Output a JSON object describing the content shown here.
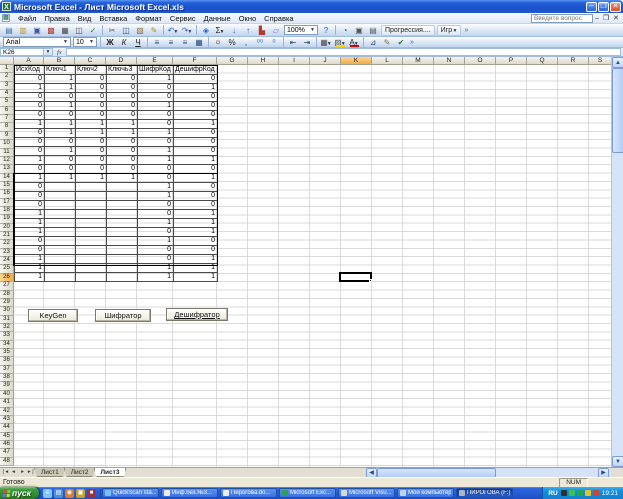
{
  "window": {
    "title": "Microsoft Excel - Лист Microsoft Excel.xls",
    "question_placeholder": "Введите вопрос"
  },
  "menus": [
    {
      "key": "file",
      "label": "Файл"
    },
    {
      "key": "edit",
      "label": "Правка"
    },
    {
      "key": "view",
      "label": "Вид"
    },
    {
      "key": "insert",
      "label": "Вставка"
    },
    {
      "key": "format",
      "label": "Формат"
    },
    {
      "key": "tools",
      "label": "Сервис"
    },
    {
      "key": "data",
      "label": "Данные"
    },
    {
      "key": "window",
      "label": "Окно"
    },
    {
      "key": "help",
      "label": "Справка"
    }
  ],
  "toolbar": {
    "font_name": "Arial",
    "font_size": "10",
    "zoom": "100%",
    "fx_label": "fx"
  },
  "toolbar1": [
    {
      "t": "i",
      "n": "new-icon",
      "g": "▤",
      "c": "#3a6ea5"
    },
    {
      "t": "i",
      "n": "open-icon",
      "g": "▥",
      "c": "#c09731"
    },
    {
      "t": "i",
      "n": "save-icon",
      "g": "▣",
      "c": "#39589c"
    },
    {
      "t": "i",
      "n": "permission-icon",
      "g": "▩",
      "c": "#b03a2e"
    },
    {
      "t": "i",
      "n": "print-icon",
      "g": "▦",
      "c": "#4a4a4a"
    },
    {
      "t": "i",
      "n": "print-preview-icon",
      "g": "◫",
      "c": "#4a4a4a"
    },
    {
      "t": "i",
      "n": "spelling-icon",
      "g": "✓",
      "c": "#2e7d32"
    },
    {
      "t": "s"
    },
    {
      "t": "i",
      "n": "cut-icon",
      "g": "✂",
      "c": "#555555"
    },
    {
      "t": "i",
      "n": "copy-icon",
      "g": "◫",
      "c": "#2b4a7d"
    },
    {
      "t": "i",
      "n": "paste-icon",
      "g": "▧",
      "c": "#8a6d3b"
    },
    {
      "t": "i",
      "n": "format-painter-icon",
      "g": "✎",
      "c": "#b58900"
    },
    {
      "t": "s"
    },
    {
      "t": "i",
      "n": "undo-icon",
      "g": "↶",
      "c": "#2b62c9",
      "d": 1
    },
    {
      "t": "i",
      "n": "redo-icon",
      "g": "↷",
      "c": "#2b62c9",
      "d": 1
    },
    {
      "t": "s"
    },
    {
      "t": "i",
      "n": "hyperlink-icon",
      "g": "◈",
      "c": "#2b62c9"
    },
    {
      "t": "i",
      "n": "autosum-icon",
      "g": "Σ",
      "c": "#222222",
      "d": 1
    },
    {
      "t": "i",
      "n": "sort-ascending-icon",
      "g": "↓",
      "c": "#2b62c9"
    },
    {
      "t": "i",
      "n": "sort-descending-icon",
      "g": "↑",
      "c": "#2b62c9"
    },
    {
      "t": "i",
      "n": "chart-wizard-icon",
      "g": "▙",
      "c": "#b03a2e"
    },
    {
      "t": "i",
      "n": "drawing-icon",
      "g": "▱",
      "c": "#6a5acd"
    },
    {
      "t": "z"
    },
    {
      "t": "i",
      "n": "help-icon",
      "g": "?",
      "c": "#1a5bd0"
    },
    {
      "t": "s"
    },
    {
      "t": "i",
      "n": "custom-tool-icon-1",
      "g": "◔",
      "c": "#2b4a7d"
    },
    {
      "t": "i",
      "n": "camera-icon",
      "g": "▣",
      "c": "#555555"
    },
    {
      "t": "i",
      "n": "document-tool-icon",
      "g": "▤",
      "c": "#555555"
    },
    {
      "t": "b",
      "n": "progression-button",
      "label": "Прогрессия...."
    },
    {
      "t": "b",
      "n": "igr-button",
      "label": "Игр",
      "d": 1
    },
    {
      "t": "v",
      "n": "toolbar-options-icon"
    }
  ],
  "toolbar2": [
    {
      "t": "font"
    },
    {
      "t": "size"
    },
    {
      "t": "s"
    },
    {
      "t": "i",
      "n": "bold-icon",
      "g": "Ж",
      "c": "#222222",
      "cls": "g-b"
    },
    {
      "t": "i",
      "n": "italic-icon",
      "g": "К",
      "c": "#222222",
      "cls": "g-i"
    },
    {
      "t": "i",
      "n": "underline-icon",
      "g": "Ч",
      "c": "#222222",
      "cls": "g-u"
    },
    {
      "t": "s"
    },
    {
      "t": "i",
      "n": "align-left-icon",
      "g": "≡",
      "c": "#2b4a7d"
    },
    {
      "t": "i",
      "n": "align-center-icon",
      "g": "≡",
      "c": "#2b4a7d"
    },
    {
      "t": "i",
      "n": "align-right-icon",
      "g": "≡",
      "c": "#2b4a7d"
    },
    {
      "t": "i",
      "n": "merge-center-icon",
      "g": "▦",
      "c": "#2b4a7d"
    },
    {
      "t": "s"
    },
    {
      "t": "i",
      "n": "currency-icon",
      "g": "¤",
      "c": "#8a6d3b"
    },
    {
      "t": "i",
      "n": "percent-icon",
      "g": "%",
      "c": "#222222"
    },
    {
      "t": "i",
      "n": "comma-style-icon",
      "g": ",",
      "c": "#222222"
    },
    {
      "t": "i",
      "n": "increase-decimal-icon",
      "g": "⁰⁰",
      "c": "#2b62c9"
    },
    {
      "t": "i",
      "n": "decrease-decimal-icon",
      "g": "⁰",
      "c": "#2b62c9"
    },
    {
      "t": "s"
    },
    {
      "t": "i",
      "n": "decrease-indent-icon",
      "g": "⇤",
      "c": "#2b4a7d"
    },
    {
      "t": "i",
      "n": "increase-indent-icon",
      "g": "⇥",
      "c": "#2b4a7d"
    },
    {
      "t": "s"
    },
    {
      "t": "i",
      "n": "borders-icon",
      "g": "▦",
      "c": "#4a4a4a",
      "d": 1
    },
    {
      "t": "i",
      "n": "fill-color-icon",
      "g": "▨",
      "c": "#4a4a4a",
      "bar": "#ffd400",
      "d": 1
    },
    {
      "t": "i",
      "n": "font-color-icon",
      "g": "А",
      "c": "#222222",
      "bar": "#d00000",
      "d": 1
    },
    {
      "t": "s"
    },
    {
      "t": "i",
      "n": "draw-select-icon",
      "g": "⊿",
      "c": "#2b4a7d"
    },
    {
      "t": "i",
      "n": "pen-icon",
      "g": "✎",
      "c": "#8a6d3b"
    },
    {
      "t": "i",
      "n": "accept-icon",
      "g": "✔",
      "c": "#2e7d32"
    },
    {
      "t": "v",
      "n": "toolbar2-options-icon"
    }
  ],
  "formula_bar": {
    "name_box": "K26"
  },
  "sheet": {
    "columns": [
      "A",
      "B",
      "C",
      "D",
      "E",
      "F",
      "G",
      "H",
      "I",
      "J",
      "K",
      "L",
      "M",
      "N",
      "O",
      "P",
      "Q",
      "R",
      "S"
    ],
    "total_rows": 48,
    "selected": {
      "column": "K",
      "row": 26,
      "ref": "K26"
    },
    "table": {
      "headers": [
        "ИсхКод",
        "Ключ1",
        "Ключ2",
        "Ключь3",
        "ШифрКод",
        "ДешифрКод"
      ],
      "rows": [
        [
          "0",
          "1",
          "0",
          "0",
          "1",
          "0"
        ],
        [
          "1",
          "1",
          "0",
          "0",
          "0",
          "1"
        ],
        [
          "0",
          "0",
          "0",
          "0",
          "0",
          "0"
        ],
        [
          "0",
          "1",
          "0",
          "0",
          "1",
          "0"
        ],
        [
          "0",
          "0",
          "0",
          "0",
          "0",
          "0"
        ],
        [
          "1",
          "1",
          "1",
          "1",
          "0",
          "1"
        ],
        [
          "0",
          "1",
          "1",
          "1",
          "1",
          "0"
        ],
        [
          "0",
          "0",
          "0",
          "0",
          "0",
          "0"
        ],
        [
          "0",
          "1",
          "0",
          "0",
          "1",
          "0"
        ],
        [
          "1",
          "0",
          "0",
          "0",
          "1",
          "1"
        ],
        [
          "0",
          "0",
          "0",
          "0",
          "0",
          "0"
        ],
        [
          "1",
          "1",
          "1",
          "1",
          "0",
          "1"
        ],
        [
          "0",
          "",
          "",
          "",
          "1",
          "0"
        ],
        [
          "0",
          "",
          "",
          "",
          "1",
          "0"
        ],
        [
          "0",
          "",
          "",
          "",
          "0",
          "0"
        ],
        [
          "1",
          "",
          "",
          "",
          "0",
          "1"
        ],
        [
          "1",
          "",
          "",
          "",
          "1",
          "1"
        ],
        [
          "1",
          "",
          "",
          "",
          "0",
          "1"
        ],
        [
          "0",
          "",
          "",
          "",
          "1",
          "0"
        ],
        [
          "0",
          "",
          "",
          "",
          "0",
          "0"
        ],
        [
          "1",
          "",
          "",
          "",
          "0",
          "1"
        ],
        [
          "1",
          "",
          "",
          "",
          "1",
          "1"
        ],
        [
          "1",
          "",
          "",
          "",
          "1",
          "1"
        ]
      ]
    },
    "buttons": [
      {
        "key": "keygen",
        "label": "KeyGen",
        "underline": false
      },
      {
        "key": "cipher",
        "label": "Шифратор",
        "underline": false
      },
      {
        "key": "decipher",
        "label": "Дешифратор",
        "underline": true
      }
    ]
  },
  "tabs": {
    "items": [
      "Лист1",
      "Лист2",
      "Лист3"
    ],
    "active": "Лист3"
  },
  "status": {
    "ready": "Готово",
    "num": "NUM"
  },
  "taskbar": {
    "start_label": "пуск",
    "quick_launch": [
      {
        "name": "quick-launch-ie-icon",
        "glyph": "e",
        "color": "#7ec4f4"
      },
      {
        "name": "quick-launch-desktop-icon",
        "glyph": "▤",
        "color": "#4a90d9"
      },
      {
        "name": "quick-launch-media-icon",
        "glyph": "◉",
        "color": "#e07b28"
      },
      {
        "name": "quick-launch-folder-icon",
        "glyph": "▣",
        "color": "#c9a227"
      },
      {
        "name": "quick-launch-app-icon",
        "glyph": "■",
        "color": "#a0303e"
      }
    ],
    "buttons": [
      {
        "key": "quickscan",
        "label": "QuickScan sta...",
        "icon_color": "#79c1f1",
        "pressed": false
      },
      {
        "key": "doc-infbez",
        "label": "Инф.без.№3...",
        "icon_color": "#f0ece0",
        "pressed": false
      },
      {
        "key": "doc-pirogova",
        "label": "Пирогова.do...",
        "icon_color": "#f0ece0",
        "pressed": false
      },
      {
        "key": "excel",
        "label": "Microsoft Exc...",
        "icon_color": "#2f9e57",
        "pressed": false
      },
      {
        "key": "visual",
        "label": "Microsoft Visu...",
        "icon_color": "#d8d8d8",
        "pressed": false
      },
      {
        "key": "my-computer",
        "label": "Мой компьютер",
        "icon_color": "#bcd4ea",
        "pressed": false
      },
      {
        "key": "drive-f",
        "label": "ПИРОГОВА (F:)",
        "icon_color": "#aab6c6",
        "pressed": true
      }
    ],
    "tray": {
      "lang": "RU",
      "time": "19:21",
      "icons": [
        {
          "name": "tray-icon-shield",
          "color": "#2f2f2f"
        },
        {
          "name": "tray-icon-antivirus",
          "color": "#39c24d"
        },
        {
          "name": "tray-icon-network",
          "color": "#1fa84b"
        },
        {
          "name": "tray-icon-volume",
          "color": "#e6c229"
        },
        {
          "name": "tray-icon-update",
          "color": "#cc4433"
        }
      ]
    }
  }
}
